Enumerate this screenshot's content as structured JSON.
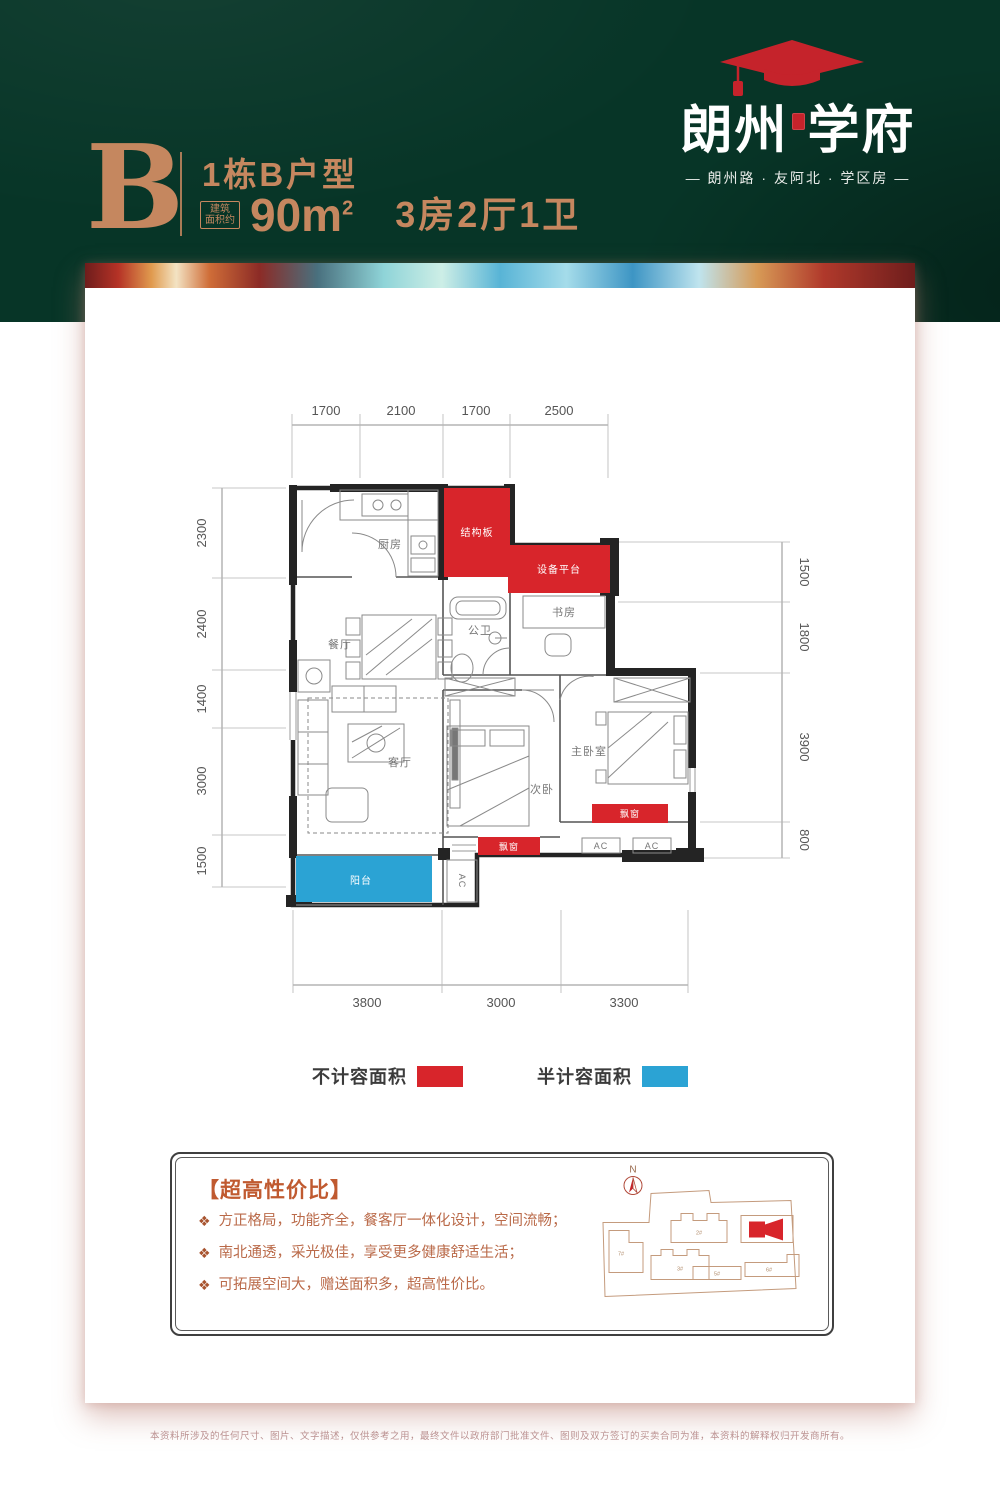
{
  "logo": {
    "brand_left": "朗州",
    "brand_right": "学府",
    "tagline": "— 朗州路 · 友阿北 · 学区房 —"
  },
  "header": {
    "unit_letter": "B",
    "unit_title": "1栋B户型",
    "area_badge_line1": "建筑",
    "area_badge_line2": "面积约",
    "area_value": "90m",
    "area_sup": "2",
    "rooms": "3房2厅1卫"
  },
  "floorplan": {
    "dims_top": [
      "1700",
      "2100",
      "1700",
      "2500"
    ],
    "dims_left": [
      "2300",
      "2400",
      "1400",
      "3000",
      "1500"
    ],
    "dims_right": [
      "1500",
      "1800",
      "3900",
      "800"
    ],
    "dims_bottom": [
      "3800",
      "3000",
      "3300"
    ],
    "labels": {
      "kitchen": "厨房",
      "dining": "餐厅",
      "living": "客厅",
      "bath": "公卫",
      "study": "书房",
      "bedroom2": "次卧",
      "master": "主卧室",
      "balcony": "阳台",
      "structural": "结构板",
      "equipment": "设备平台",
      "bay_window": "飘窗",
      "ac": "AC"
    }
  },
  "legend": [
    {
      "label": "不计容面积",
      "color": "#d8252b"
    },
    {
      "label": "半计容面积",
      "color": "#2ba3d4"
    }
  ],
  "features": {
    "title": "【超高性价比】",
    "bullet_icon": "❖",
    "items": [
      "方正格局，功能齐全，餐客厅一体化设计，空间流畅；",
      "南北通透，采光极佳，享受更多健康舒适生活；",
      "可拓展空间大，赠送面积多，超高性价比。"
    ]
  },
  "siteplan": {
    "north": "N",
    "buildings": [
      "7#",
      "2#",
      "3#",
      "5#",
      "6#"
    ]
  },
  "footer": {
    "disclaimer": "本资料所涉及的任何尺寸、图片、文字描述，仅供参考之用，最终文件以政府部门批准文件、图则及双方签订的买卖合同为准，本资料的解释权归开发商所有。"
  },
  "colors": {
    "brand_red": "#c5232b",
    "plan_red": "#d8252b",
    "plan_blue": "#2ba3d4",
    "copper": "#c5875f"
  }
}
